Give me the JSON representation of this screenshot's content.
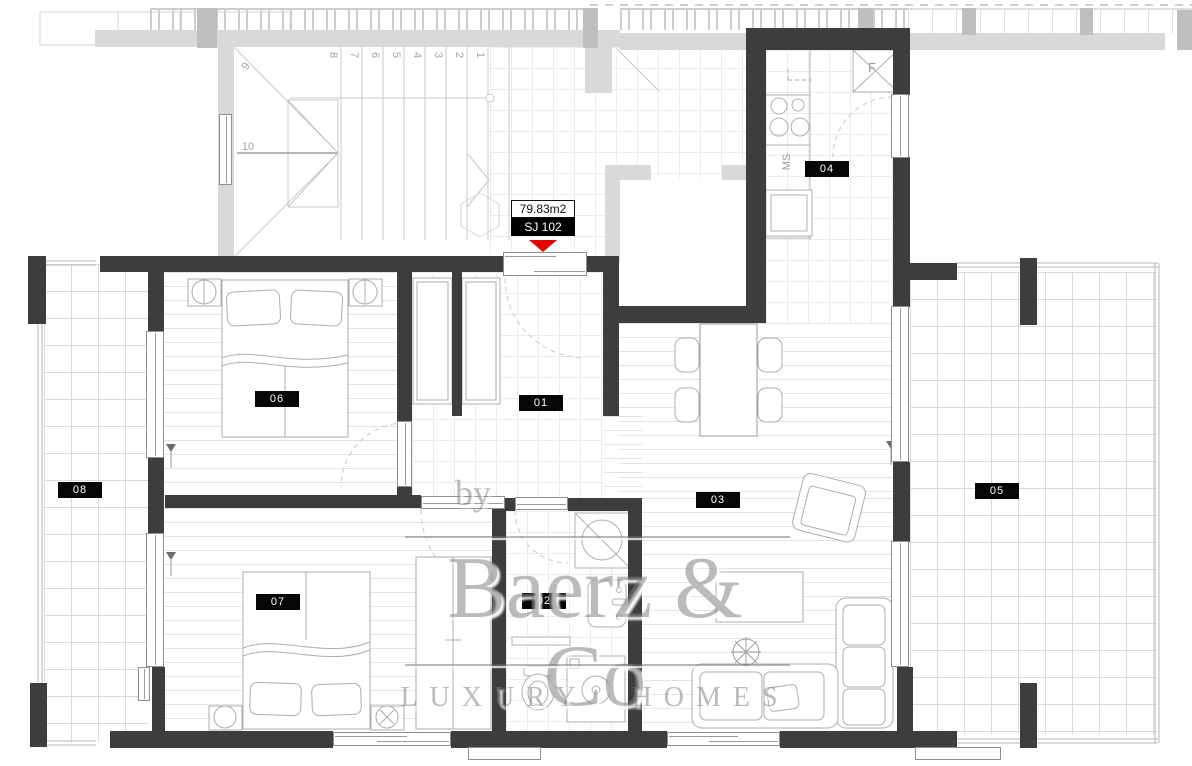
{
  "callout": {
    "area": "79.83m2",
    "unit": "SJ 102"
  },
  "rooms": [
    {
      "label": "01"
    },
    {
      "label": "02"
    },
    {
      "label": "03"
    },
    {
      "label": "04"
    },
    {
      "label": "05"
    },
    {
      "label": "06"
    },
    {
      "label": "07"
    },
    {
      "label": "08"
    }
  ],
  "stairs": {
    "steps": [
      "1",
      "2",
      "3",
      "4",
      "5",
      "6",
      "7",
      "8",
      "9",
      "10"
    ]
  },
  "kitchen_labels": {
    "fridge": "F",
    "appliance": "MS"
  },
  "watermark": {
    "prefix": "by",
    "brand": "Baerz & Co",
    "tagline": "LUXURY HOMES"
  },
  "colors": {
    "wall": "#3d3d3d",
    "neighbor_wall": "#d9d9d9",
    "marker_red": "#e60004",
    "label_bg": "#060606"
  }
}
